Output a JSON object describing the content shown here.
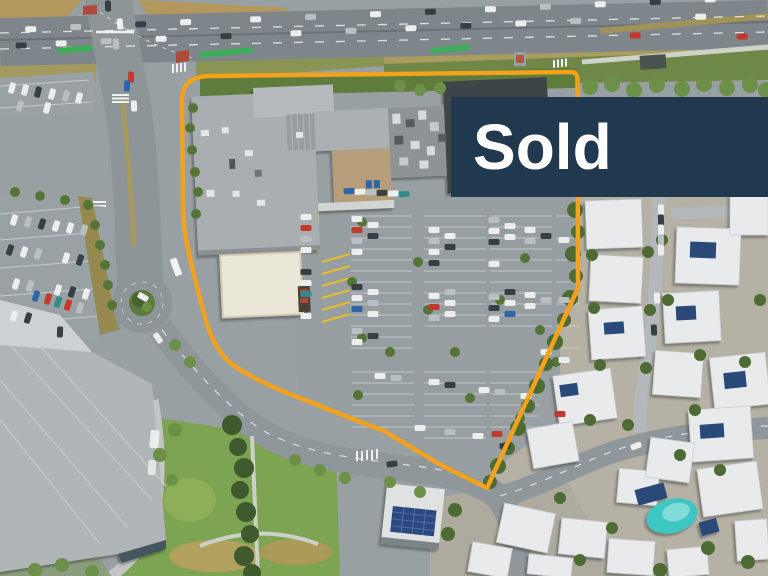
{
  "banner": {
    "label": "Sold"
  },
  "colors": {
    "banner_bg": "#20394e",
    "banner_text": "#ffffff",
    "boundary": "#f2a21c"
  }
}
